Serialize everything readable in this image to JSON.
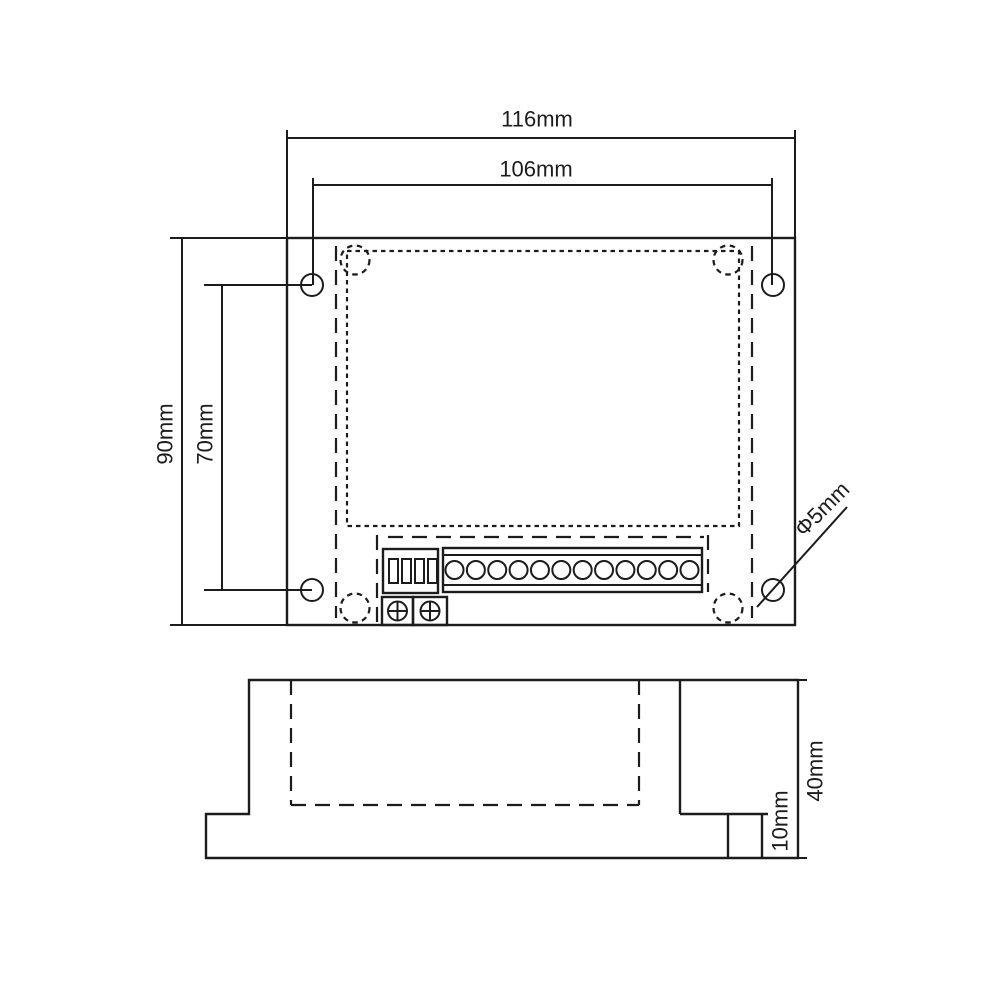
{
  "drawing": {
    "background_color": "#ffffff",
    "line_color": "#1c1c1c",
    "dimensions": {
      "overall_width": "116mm",
      "hole_spacing_width": "106mm",
      "overall_depth": "90mm",
      "hole_spacing_depth": "70mm",
      "hole_diameter": "Φ5mm",
      "overall_height": "40mm",
      "base_height": "10mm"
    },
    "components": {
      "mounting_holes": {
        "count": 4
      },
      "corner_standoffs": {
        "count": 4
      },
      "dip_switch": {
        "switch_count": 4
      },
      "terminal_block": {
        "terminal_count": 12
      },
      "screw_terminals": {
        "count": 2
      }
    }
  }
}
